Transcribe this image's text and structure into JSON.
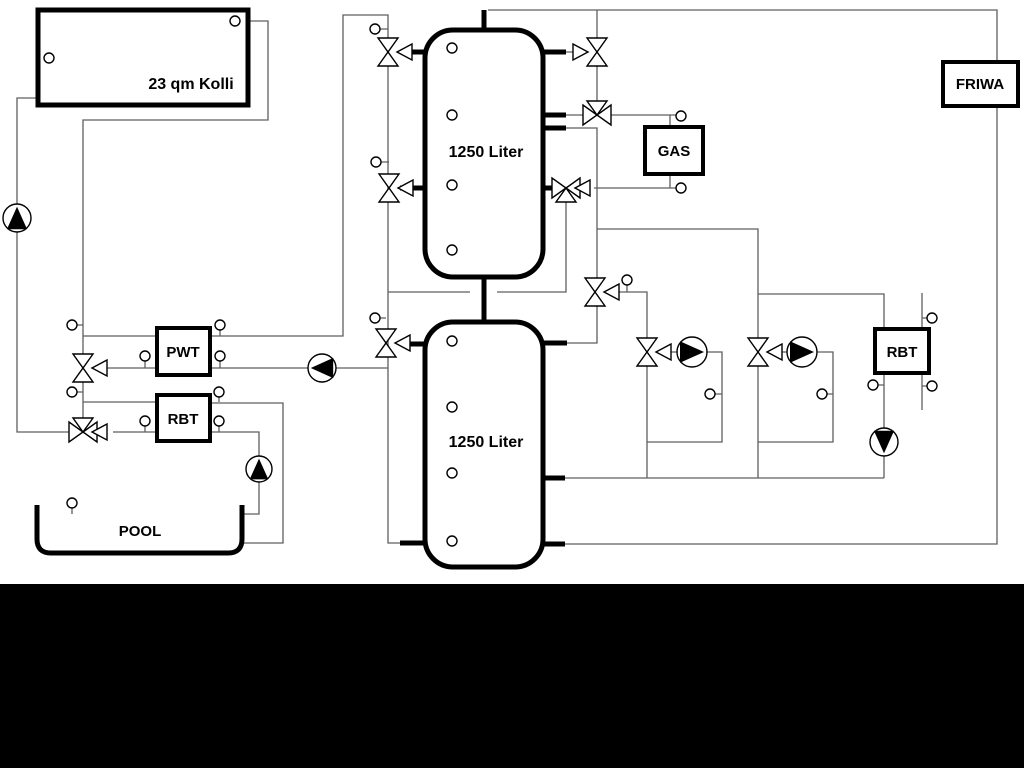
{
  "diagram": {
    "collector": {
      "label": "23 qm Kolli"
    },
    "buffer_tank_top": {
      "label": "1250 Liter"
    },
    "buffer_tank_bottom": {
      "label": "1250 Liter"
    },
    "gas_boiler": {
      "label": "GAS"
    },
    "friwa_station": {
      "label": "FRIWA"
    },
    "pwt_exchanger": {
      "label": "PWT"
    },
    "rbt_exchanger_left": {
      "label": "RBT"
    },
    "rbt_exchanger_right": {
      "label": "RBT"
    },
    "pool": {
      "label": "POOL"
    },
    "colors": {
      "pipe": "#5f5f5f",
      "symbol_outline": "#000000",
      "background": "#ffffff",
      "footer_bar": "#000000"
    },
    "icons": {
      "pump": "pump-icon (circle with solid triangle: up, left, up, right, right, down)",
      "valve": "three-way-valve-icon",
      "sensor": "temperature-sensor-icon"
    }
  }
}
